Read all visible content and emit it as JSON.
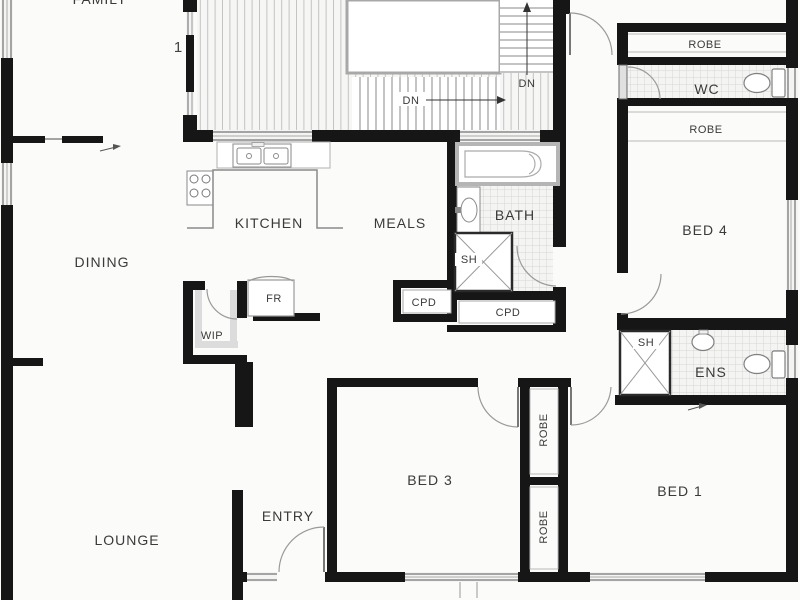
{
  "title": "House floor plan",
  "labels": {
    "family": "FAMILY",
    "dining": "DINING",
    "kitchen": "KITCHEN",
    "meals": "MEALS",
    "lounge": "LOUNGE",
    "entry": "ENTRY",
    "bed1": "BED 1",
    "bed3": "BED 3",
    "bed4": "BED 4",
    "bath": "BATH",
    "ens": "ENS",
    "wc": "WC",
    "wip": "WIP",
    "fr": "FR",
    "robe_top": "ROBE",
    "robe_mid": "ROBE",
    "robe_v1": "ROBE",
    "robe_v2": "ROBE",
    "sh_bath": "SH",
    "sh_ens": "SH",
    "cpd_left": "CPD",
    "cpd_right": "CPD",
    "dn_upper": "DN",
    "dn_lower": "DN",
    "level_marker": "1"
  },
  "colors": {
    "wall": "#161616",
    "fixture_line": "#8f8f8f",
    "door_arc": "#9a9a9a",
    "tile_line": "#d6d6d6",
    "deck_line": "#c3c3c3",
    "text": "#3a3a3a",
    "background": "#fbfbf9"
  }
}
